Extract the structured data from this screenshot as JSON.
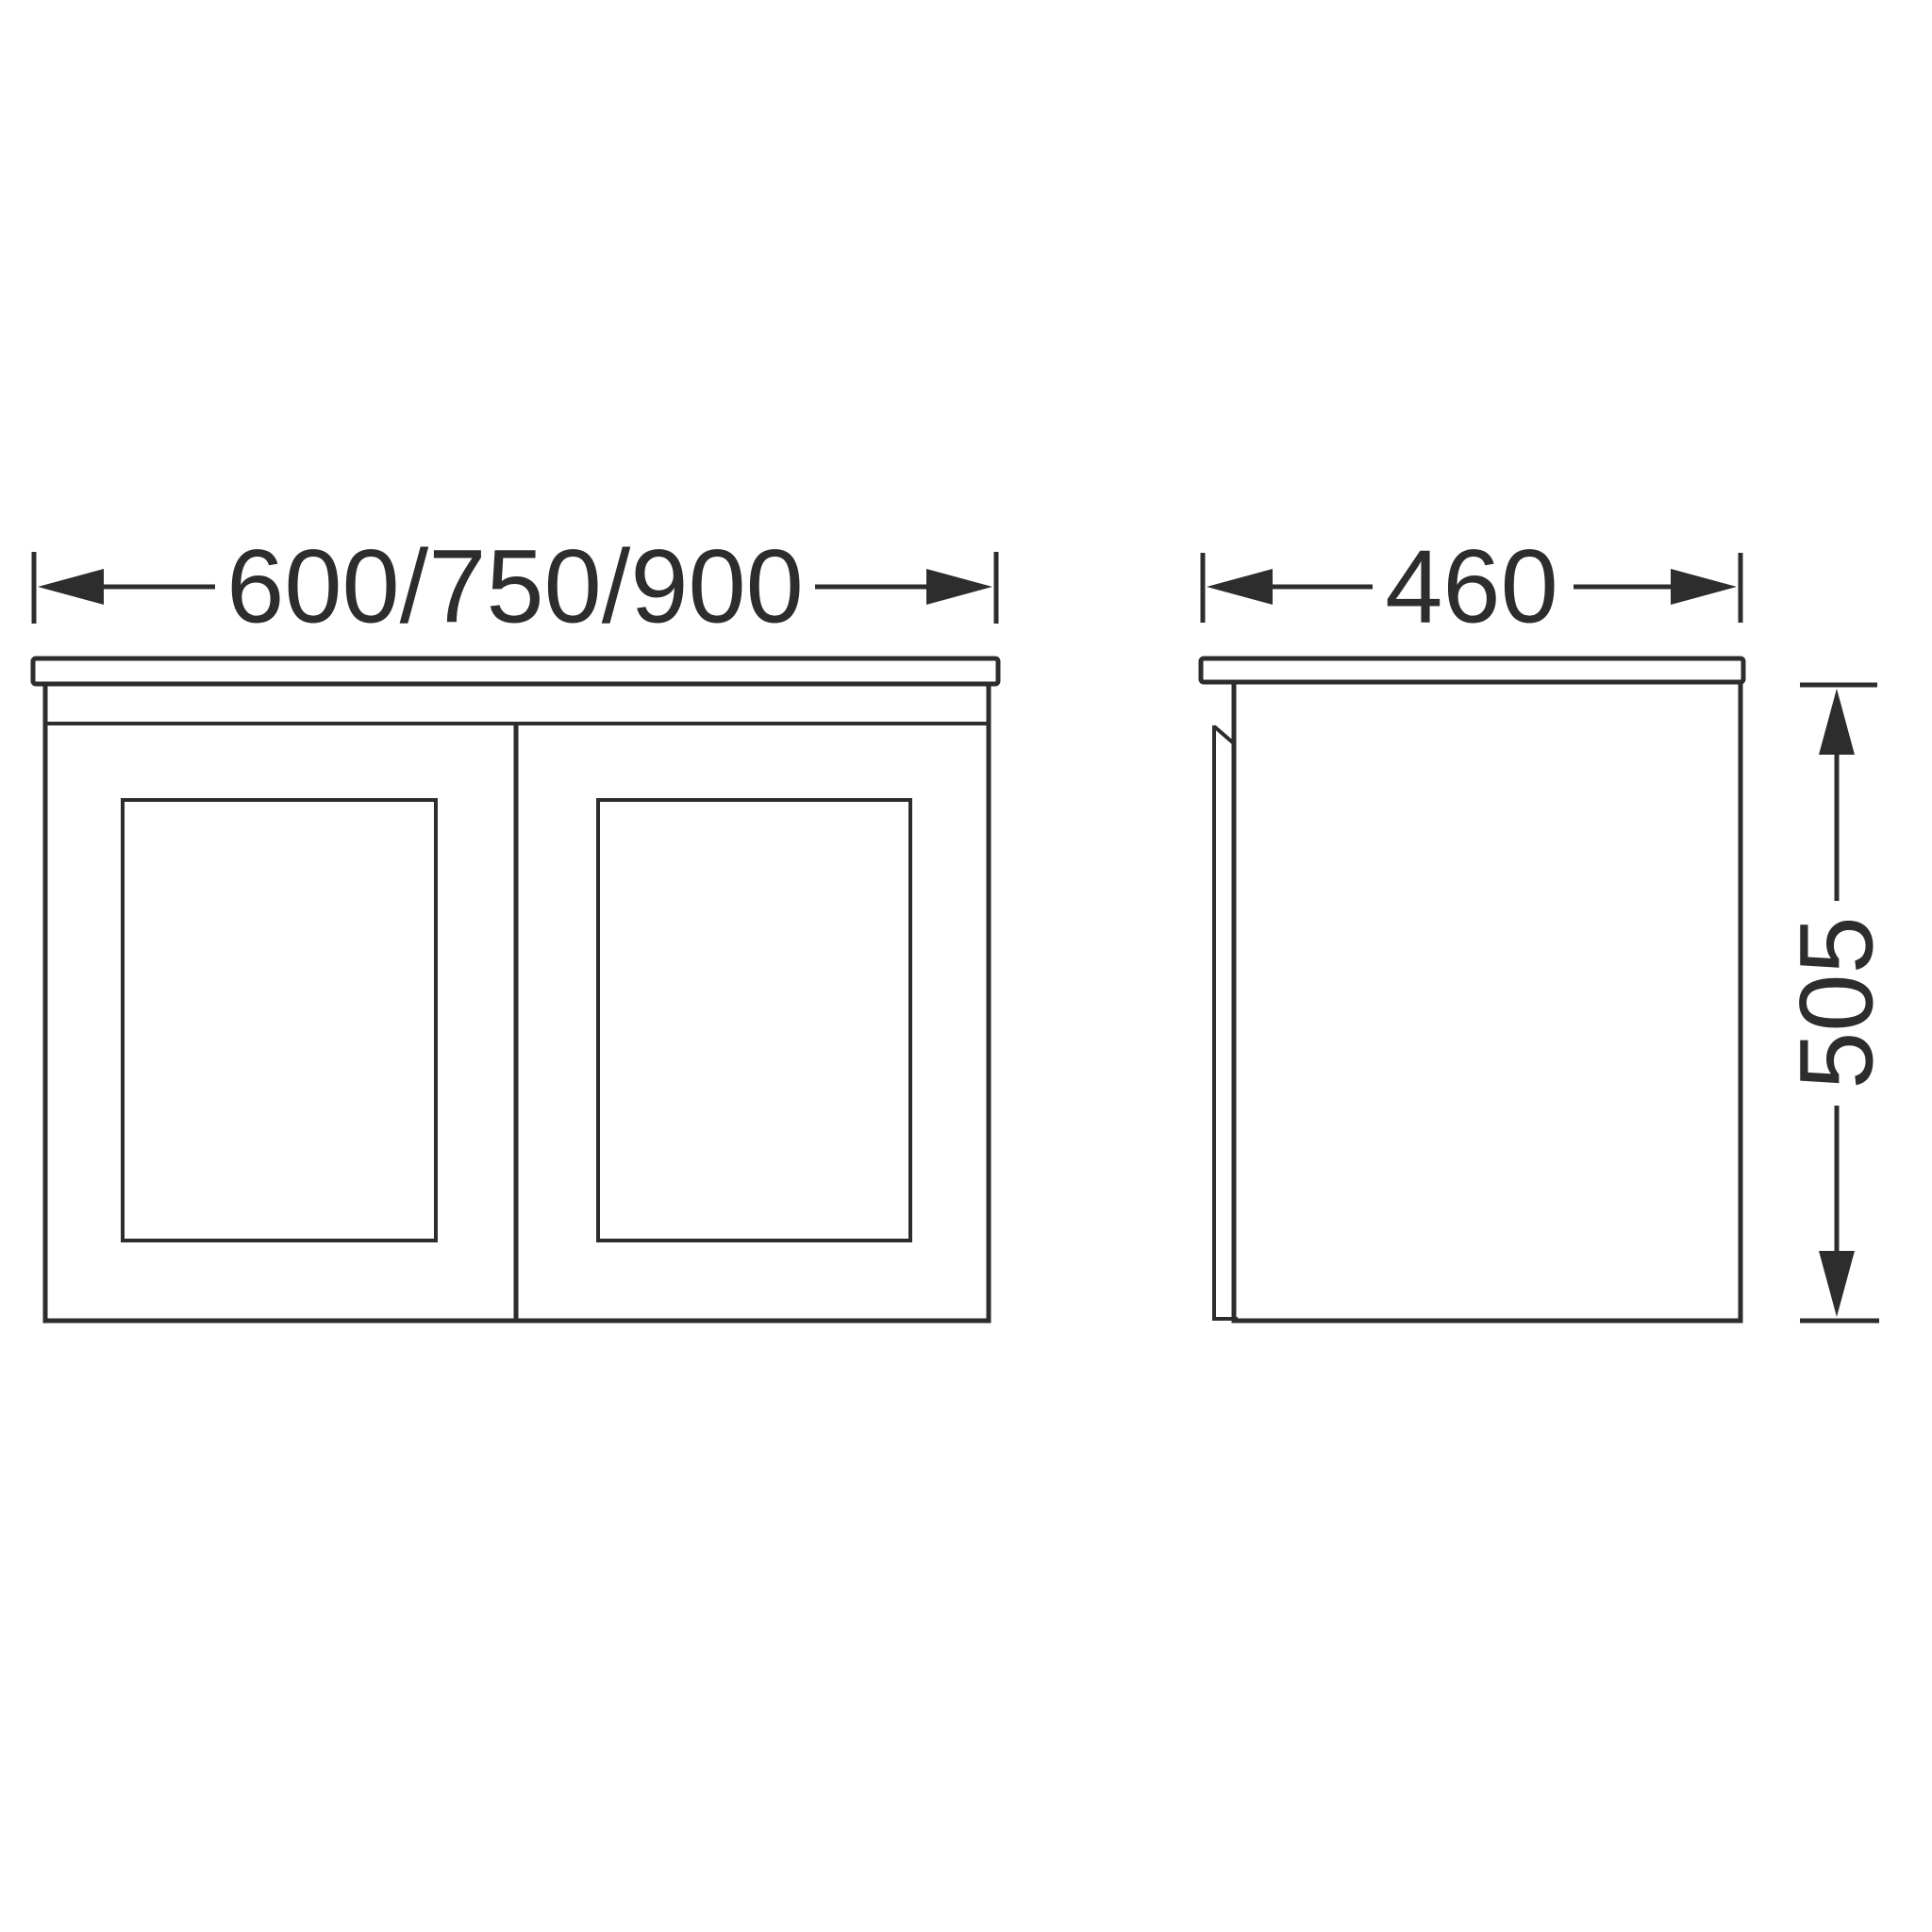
{
  "theme": {
    "background": "#ffffff",
    "line_color": "#2d2d2d"
  },
  "dimensions": {
    "front_width": "600/750/900",
    "side_depth": "460",
    "side_height": "505"
  }
}
